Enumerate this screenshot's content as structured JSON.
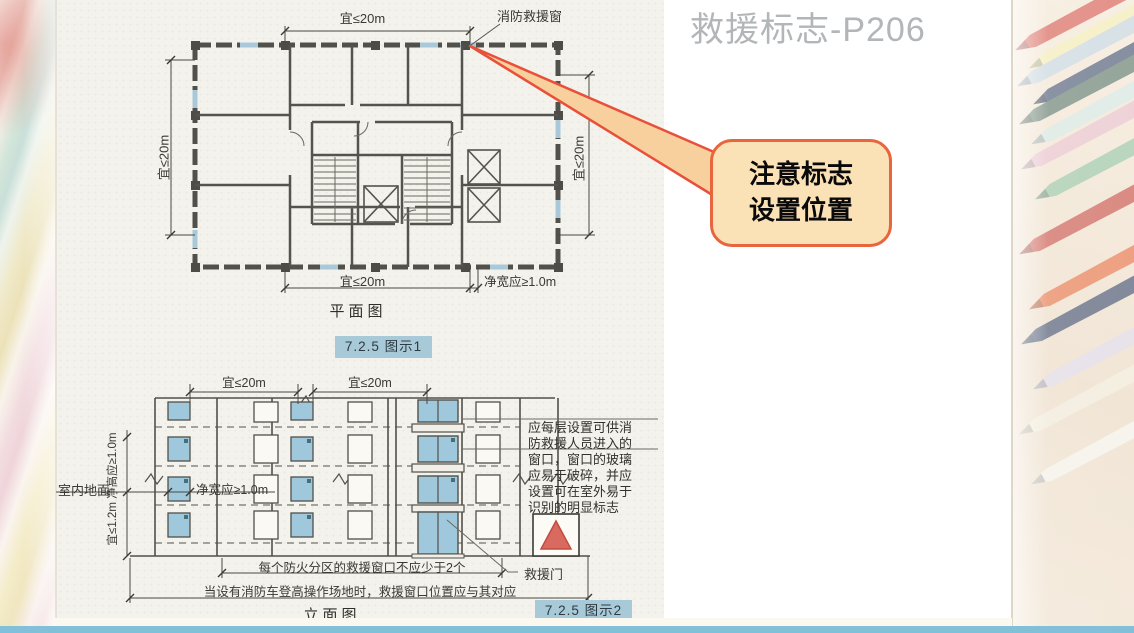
{
  "slide": {
    "title": "救援标志-P206",
    "callout": {
      "line1": "注意标志",
      "line2": "设置位置"
    }
  },
  "plan": {
    "caption": "平面图",
    "badge": "7.2.5 图示1",
    "rescue_window_label": "消防救援窗",
    "dims": {
      "top": "宜≤20m",
      "left": "宜≤20m",
      "right": "宜≤20m",
      "bottom": "宜≤20m",
      "clear_width": "净宽应≥1.0m"
    }
  },
  "elevation": {
    "caption": "立面图",
    "badge": "7.2.5 图示2",
    "dims": {
      "top_left": "宜≤20m",
      "top_right": "宜≤20m",
      "left_vertical": "宜≤1.2m 净高应≥1.0m",
      "clear_width": "净宽应≥1.0m"
    },
    "ground_label": "室内地面",
    "door_label": "救援门",
    "note_fire_compartment": "每个防火分区的救援窗口不应少于2个",
    "note_fire_truck": "当设有消防车登高操作场地时，救援窗口位置应与其对应",
    "side_note_lines": [
      "应每层设置可供消",
      "防救援人员进入的",
      "窗口，窗口的玻璃",
      "应易于破碎，并应",
      "设置可在室外易于",
      "识别的明显标志"
    ]
  },
  "colors": {
    "badge_bg": "#a7c9d8",
    "callout_bg": "#fbe2b6",
    "callout_border": "#e8653d",
    "window_blue": "#9fc8dc",
    "sign_red": "#d96a60",
    "bottom_bar_blue": "#82bfd9",
    "title_gray": "#b2b6b9"
  }
}
